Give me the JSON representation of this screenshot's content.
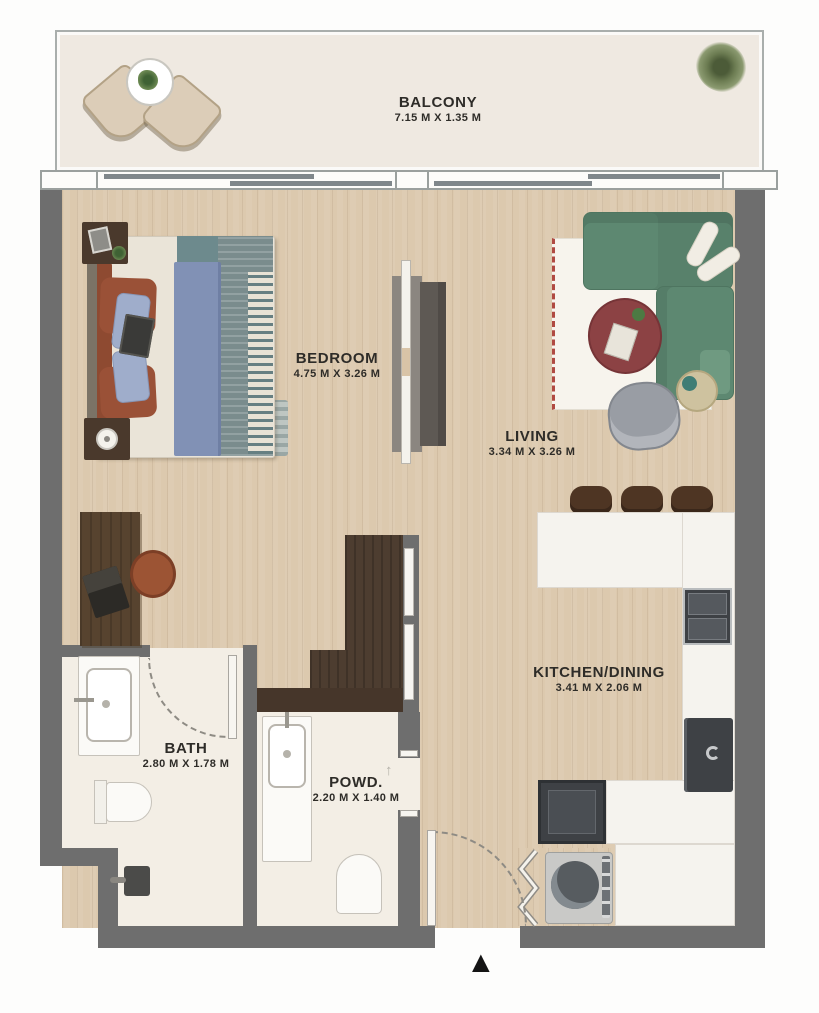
{
  "rooms": [
    {
      "name": "BALCONY",
      "dims": "7.15 M X 1.35 M"
    },
    {
      "name": "BEDROOM",
      "dims": "4.75 M X 3.26 M"
    },
    {
      "name": "LIVING",
      "dims": "3.34 M X 3.26 M"
    },
    {
      "name": "KITCHEN/DINING",
      "dims": "3.41 M X 2.06 M"
    },
    {
      "name": "BATH",
      "dims": "2.80 M X 1.78 M"
    },
    {
      "name": "POWD.",
      "dims": "2.20 M X 1.40 M"
    }
  ],
  "icons": {
    "entrance_marker": "▲",
    "slide_arrow_left": "←",
    "slide_arrow_right": "→",
    "powder_door_arrow": "↑"
  },
  "colors": {
    "wall": "#6e6e6e",
    "wood_floor": "#dcc9ae",
    "tile_floor": "#f3eee5",
    "balcony_floor": "#efe9e1",
    "sofa_green": "#5d8871",
    "coffee_table_maroon": "#8c4244",
    "closet_brown": "#4d3d30",
    "appliance_dark": "#3e4145",
    "label_text": "#2e2c28"
  }
}
